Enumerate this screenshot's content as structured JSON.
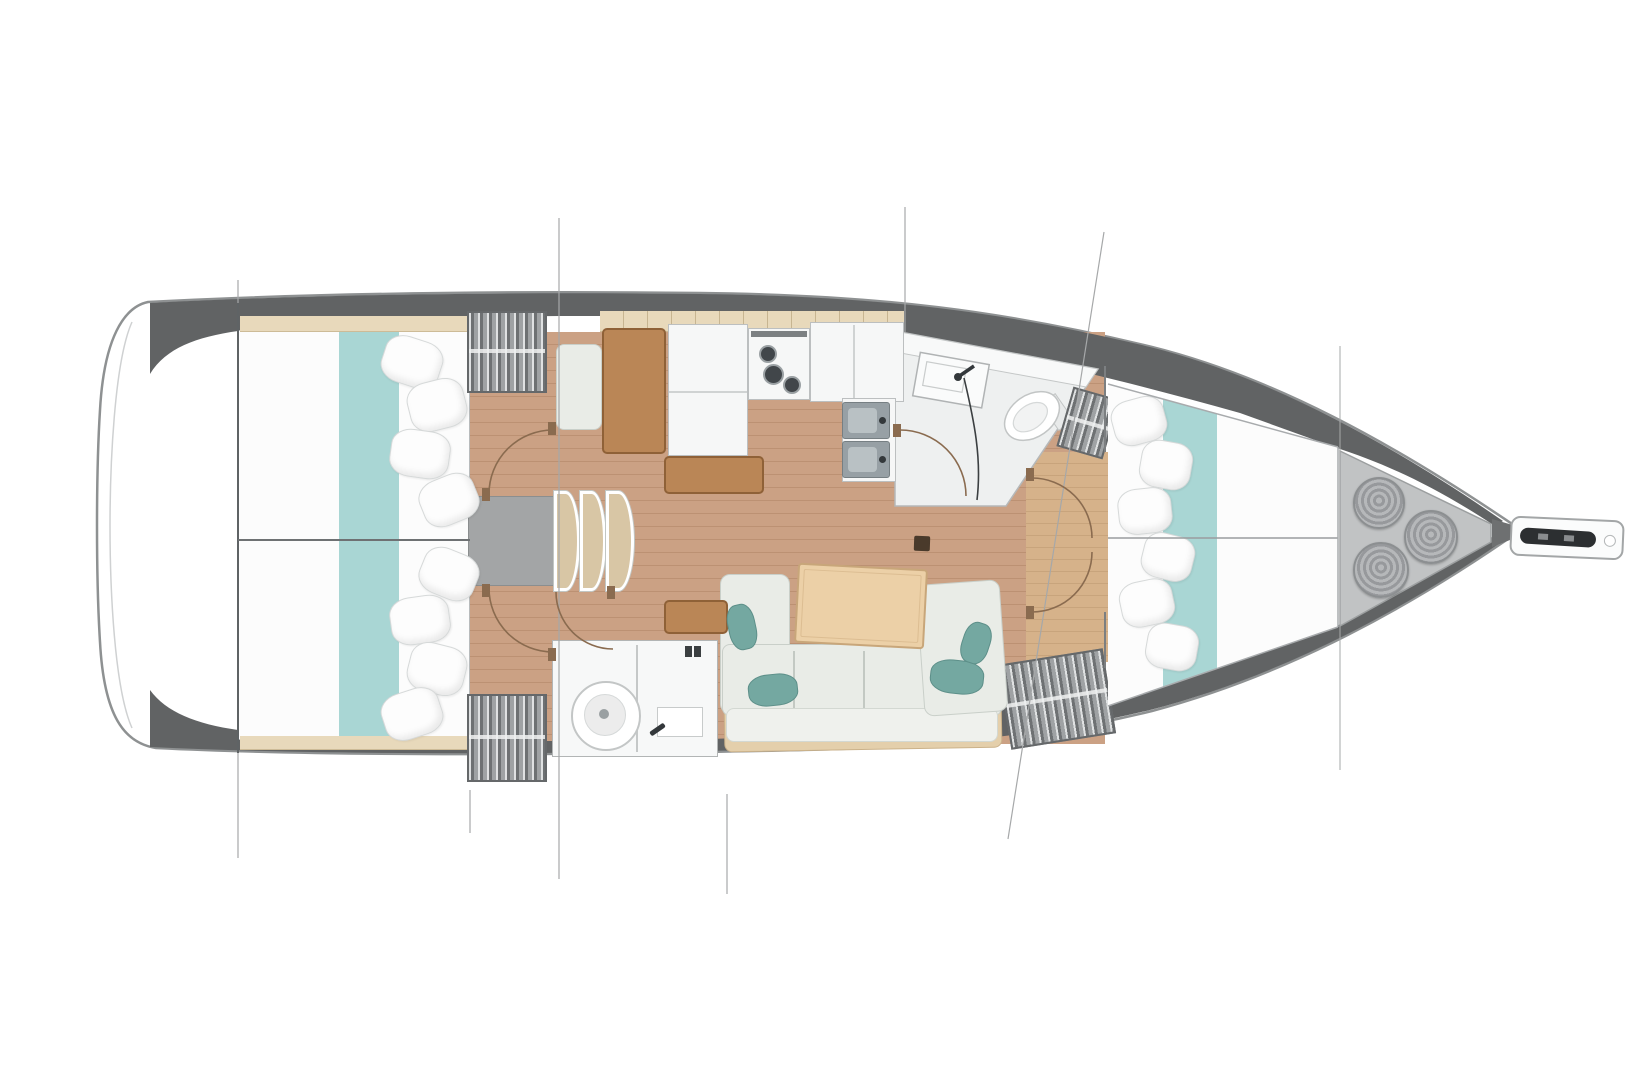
{
  "diagram": {
    "kind": "sailboat-interior-floor-plan",
    "orientation": "bow-right",
    "visible_text": ""
  },
  "colors": {
    "background": "#ffffff",
    "hull_fill": "#ffffff",
    "hull_outline": "#8e9192",
    "deck_band": "#616364",
    "wood_floor": "#cba184",
    "wood_floor_fwd": "#d6b28a",
    "bed_white": "#fcfcfc",
    "teal_runner": "#a9d6d4",
    "teal_dark": "#74a8a1",
    "beige_trim": "#e8d9bb",
    "wardrobe_dark": "#7e8183",
    "furniture_brown": "#ba8656",
    "furniture_brown_border": "#8f6137",
    "counter_white": "#f6f7f7",
    "counter_border": "#bcbfc0",
    "sink_gray": "#97a0a5",
    "steel_dark": "#33383b",
    "sofa_cushion": "#e9ece7",
    "sofa_border": "#c9cfc9",
    "sofa_frame": "#e4cfab",
    "table_wood": "#ecd0a7",
    "stairs_tread": "#d8c6a5",
    "platform_gray": "#a3a5a6",
    "locker_gray": "#c1c3c4",
    "anchor_dark": "#2c2f31",
    "door_arc": "#8a6b4f",
    "rig_line": "#a6a8a9",
    "head_floor": "#eef0f0",
    "mast": "#4a3a2b"
  },
  "rig_lines": [
    {
      "x1": 238,
      "y1": 280,
      "x2": 238,
      "y2": 858,
      "w": 1.2
    },
    {
      "x1": 470,
      "y1": 790,
      "x2": 470,
      "y2": 833,
      "w": 1.2
    },
    {
      "x1": 559,
      "y1": 218,
      "x2": 559,
      "y2": 879,
      "w": 1.2
    },
    {
      "x1": 727,
      "y1": 794,
      "x2": 727,
      "y2": 894,
      "w": 1.2
    },
    {
      "x1": 905,
      "y1": 207,
      "x2": 905,
      "y2": 332,
      "w": 1.2
    },
    {
      "x1": 1104,
      "y1": 232,
      "x2": 1008,
      "y2": 839,
      "w": 1.2
    },
    {
      "x1": 1340,
      "y1": 346,
      "x2": 1340,
      "y2": 770,
      "w": 1
    }
  ],
  "bulkhead_lines": [
    {
      "x1": 238,
      "y1": 303,
      "x2": 238,
      "y2": 753,
      "w": 2,
      "c": "#5f6365"
    },
    {
      "x1": 238,
      "y1": 540,
      "x2": 470,
      "y2": 540,
      "w": 2,
      "c": "#6e7173"
    },
    {
      "x1": 1108,
      "y1": 538,
      "x2": 1338,
      "y2": 538,
      "w": 1.5,
      "c": "#9a9c9e"
    },
    {
      "x1": 1105,
      "y1": 366,
      "x2": 1105,
      "y2": 452,
      "w": 2,
      "c": "#7c7f81"
    },
    {
      "x1": 1105,
      "y1": 612,
      "x2": 1105,
      "y2": 668,
      "w": 2,
      "c": "#7c7f81"
    },
    {
      "x1": 1108,
      "y1": 384,
      "x2": 1338,
      "y2": 447,
      "w": 1.5,
      "c": "#a8abad"
    },
    {
      "x1": 1338,
      "y1": 447,
      "x2": 1338,
      "y2": 627,
      "w": 1.5,
      "c": "#a8abad"
    },
    {
      "x1": 1108,
      "y1": 706,
      "x2": 1338,
      "y2": 627,
      "w": 1.5,
      "c": "#a8abad"
    }
  ],
  "door_arcs": [
    "M 489 494 A 64 64 0 0 1 553 430",
    "M 489 588 A 64 64 0 0 0 553 652",
    "M 556 592 A 57 57 0 0 0 613 649",
    "M 900 430 A 66 66 0 0 1 966 496",
    "M 1032 478 A 60 60 0 0 1 1092 538",
    "M 1092 552 A 60 60 0 0 1 1032 612"
  ],
  "door_jambs": [
    [
      548,
      422
    ],
    [
      482,
      488
    ],
    [
      482,
      584
    ],
    [
      548,
      648
    ],
    [
      607,
      586
    ],
    [
      893,
      424
    ],
    [
      1026,
      468
    ],
    [
      1026,
      606
    ]
  ],
  "pillows": {
    "aft_top": [
      [
        382,
        338,
        58,
        46,
        18
      ],
      [
        408,
        380,
        56,
        48,
        -14
      ],
      [
        390,
        430,
        58,
        46,
        8
      ],
      [
        420,
        476,
        56,
        46,
        -22
      ]
    ],
    "aft_bottom": [
      [
        420,
        550,
        56,
        46,
        22
      ],
      [
        390,
        596,
        58,
        46,
        -8
      ],
      [
        408,
        644,
        56,
        48,
        14
      ],
      [
        382,
        690,
        58,
        46,
        -18
      ]
    ],
    "forward": [
      [
        1112,
        398,
        52,
        44,
        -15
      ],
      [
        1140,
        441,
        50,
        46,
        10
      ],
      [
        1118,
        488,
        52,
        44,
        -6
      ],
      [
        1142,
        534,
        50,
        44,
        14
      ],
      [
        1120,
        580,
        52,
        44,
        -12
      ],
      [
        1146,
        624,
        50,
        44,
        10
      ]
    ]
  },
  "teal_pillows": [
    [
      728,
      604,
      26,
      44,
      -12
    ],
    [
      748,
      674,
      48,
      30,
      -6
    ],
    [
      930,
      660,
      52,
      32,
      6
    ],
    [
      962,
      622,
      26,
      40,
      18
    ]
  ],
  "rope_coils": [
    [
      1353,
      477,
      48
    ],
    [
      1404,
      510,
      50
    ],
    [
      1353,
      542,
      52
    ]
  ],
  "sofa_dividers": [
    70,
    140,
    210
  ],
  "galley": {
    "burners": [
      [
        765,
        351,
        14
      ],
      [
        770,
        371,
        17
      ],
      [
        789,
        382,
        14
      ]
    ],
    "sinks": [
      [
        842,
        402
      ],
      [
        842,
        441
      ]
    ]
  }
}
